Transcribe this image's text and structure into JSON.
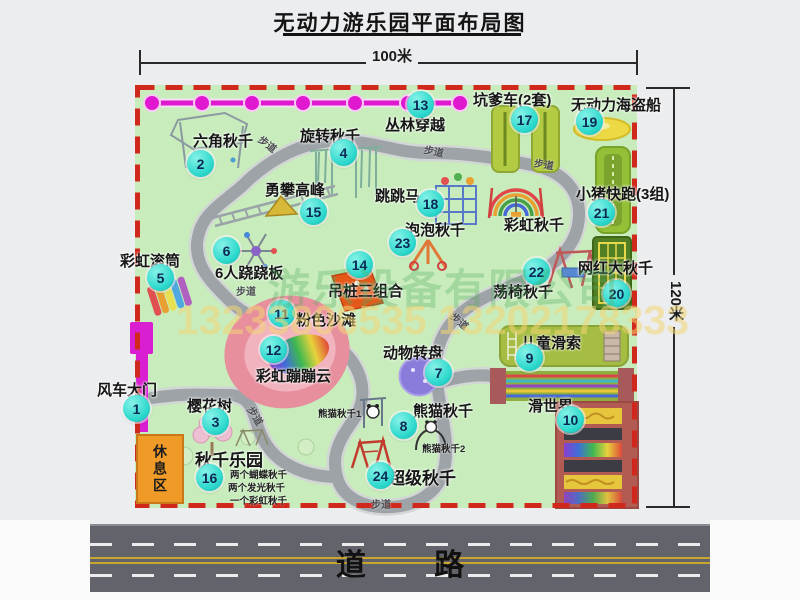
{
  "title": "无动力游乐园平面布局图",
  "dimension_top": "100米",
  "dimension_right": "120米",
  "road_label": "道 路",
  "watermark": {
    "company": "游乐设备有限公司",
    "phones": "13233806535 13202178333"
  },
  "rest_area_label": "休息区",
  "path_label": "步道",
  "rainbow_swing_label": "彩虹秋千",
  "panda_sub1": "熊猫秋千1",
  "panda_sub2": "熊猫秋千2",
  "swing_park_note1": "两个蝴蝶秋千",
  "swing_park_note2": "两个发光秋千",
  "swing_park_note3": "一个彩虹秋千",
  "attractions": [
    {
      "num": "1",
      "label": "风车大门"
    },
    {
      "num": "2",
      "label": "六角秋千"
    },
    {
      "num": "3",
      "label": "樱花树"
    },
    {
      "num": "4",
      "label": "旋转秋千"
    },
    {
      "num": "5",
      "label": "彩虹滚筒"
    },
    {
      "num": "6",
      "label": "6人跷跷板"
    },
    {
      "num": "7",
      "label": "动物转盘"
    },
    {
      "num": "8",
      "label": "熊猫秋千"
    },
    {
      "num": "9",
      "label": "儿童滑索"
    },
    {
      "num": "10",
      "label": "滑世界"
    },
    {
      "num": "11",
      "label": "粉色沙滩"
    },
    {
      "num": "12",
      "label": "彩虹蹦蹦云"
    },
    {
      "num": "13",
      "label": "丛林穿越"
    },
    {
      "num": "14",
      "label": "吊桩三组合"
    },
    {
      "num": "15",
      "label": "勇攀高峰"
    },
    {
      "num": "16",
      "label": "秋千乐园"
    },
    {
      "num": "17",
      "label": "坑爹车(2套)"
    },
    {
      "num": "18",
      "label": "跳跳马"
    },
    {
      "num": "19",
      "label": "无动力海盗船"
    },
    {
      "num": "20",
      "label": "网红大秋千"
    },
    {
      "num": "21",
      "label": "小猪快跑(3组)"
    },
    {
      "num": "22",
      "label": "荡椅秋千"
    },
    {
      "num": "23",
      "label": "泡泡秋千"
    },
    {
      "num": "24",
      "label": "超级秋千"
    }
  ]
}
